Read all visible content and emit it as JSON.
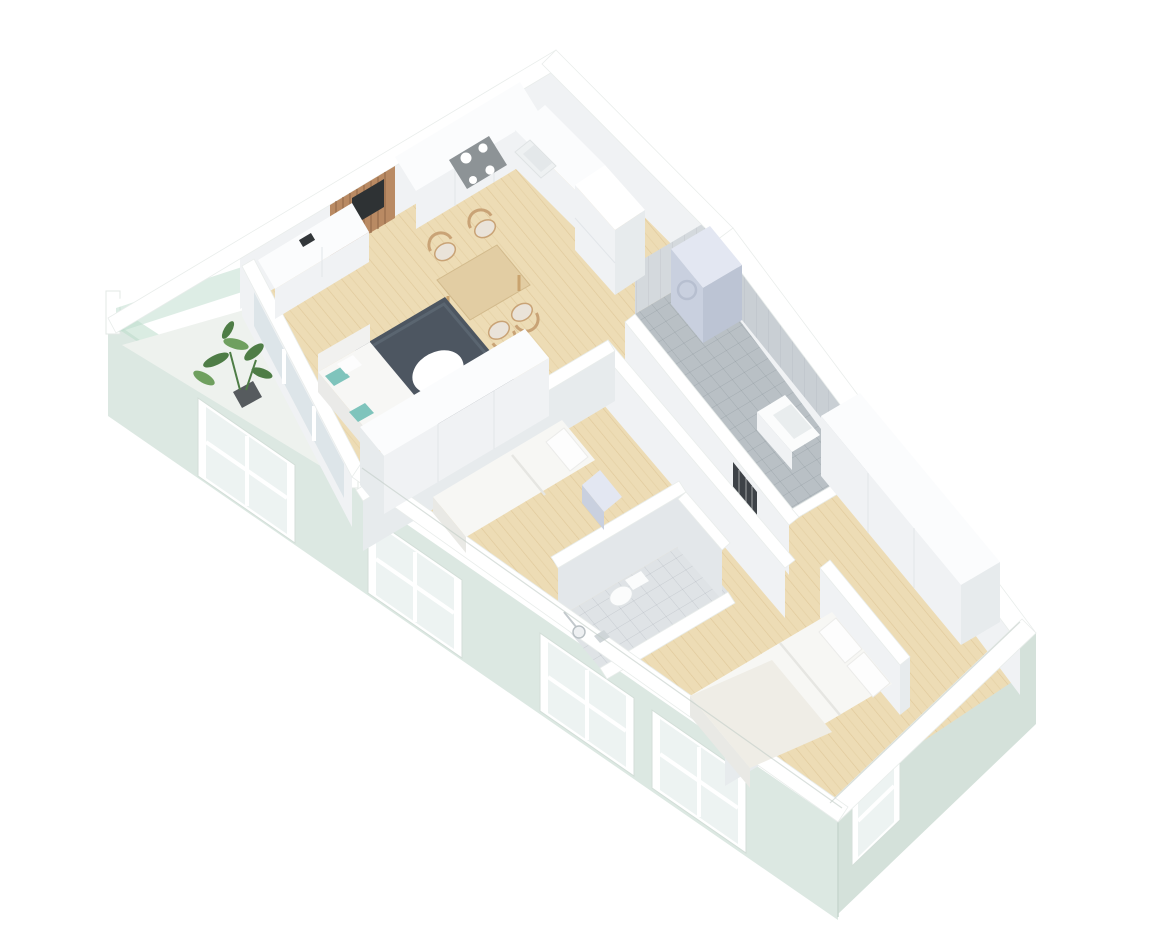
{
  "canvas": {
    "width": 1170,
    "height": 934,
    "background": "#ffffff"
  },
  "scene": {
    "type": "isometric-3d-floor-plan",
    "rooms": [
      "kitchen-living-room",
      "bedroom-small",
      "bedroom-master",
      "bathroom-large",
      "bathroom-small",
      "hallway",
      "balcony"
    ],
    "furniture": [
      "kitchen-counter",
      "cooktop",
      "kitchen-sink",
      "tall-cabinet",
      "slat-media-wall",
      "sideboard",
      "dining-table",
      "dining-chairs",
      "area-rug",
      "coffee-table",
      "sofa",
      "floor-lamp",
      "single-bed",
      "nightstand",
      "wardrobe",
      "washing-machine",
      "bathroom-sink",
      "shower-head",
      "toilet",
      "radiator",
      "double-bed",
      "wardrobe-long",
      "potted-plant",
      "doormat"
    ]
  },
  "palette": {
    "facade": "#dce8e2",
    "facade_right": "#d4e1da",
    "facade_edge": "#c6d6ce",
    "rail_glass": "#bcdccb",
    "wood": "#eddcb5",
    "balcony_floor": "#eef2ee",
    "rug": "#4d5661",
    "coffee_table": "#ffffff",
    "tile_bath1": "#b9c0c5",
    "tile_bath1_wall": "#c9cfd4",
    "tile_bath1_wall2": "#d4d9dd",
    "tile_bath2": "#dfe3e6",
    "tile_bath2_wall": "#e3e7ea",
    "wall_top": "#ffffff",
    "wall_face": "#f0f2f4",
    "wall_face_dark": "#e7ebed",
    "window_glass": "#edf3f2",
    "door_glass": "#dde5e9",
    "cooktop": "#8d9396",
    "burner": "#ffffff",
    "slats": "#b98a63",
    "tv": "#2e3234",
    "table_wood": "#e2cda3",
    "chair_wood": "#c9a376",
    "chair_seat": "#eae3d9",
    "sofa": "#f7f7f5",
    "sofa_shade": "#eaeae8",
    "pillow_teal": "#7fc4bc",
    "lamp_gold": "#c9a23e",
    "bed_linen": "#f7f7f4",
    "bed_shadow": "#e9e9e5",
    "pillow_white": "#fdfdfd",
    "appliance": "#e3e7f2",
    "appliance_shade": "#c9d0df",
    "appliance_dark": "#bcc4d4",
    "radiator": "#3d4247",
    "mat": "#6b7075",
    "plant": "#4e7d46",
    "plant_light": "#6fa05f",
    "pot": "#565b5e",
    "fixture_white": "#fbfcfc"
  }
}
